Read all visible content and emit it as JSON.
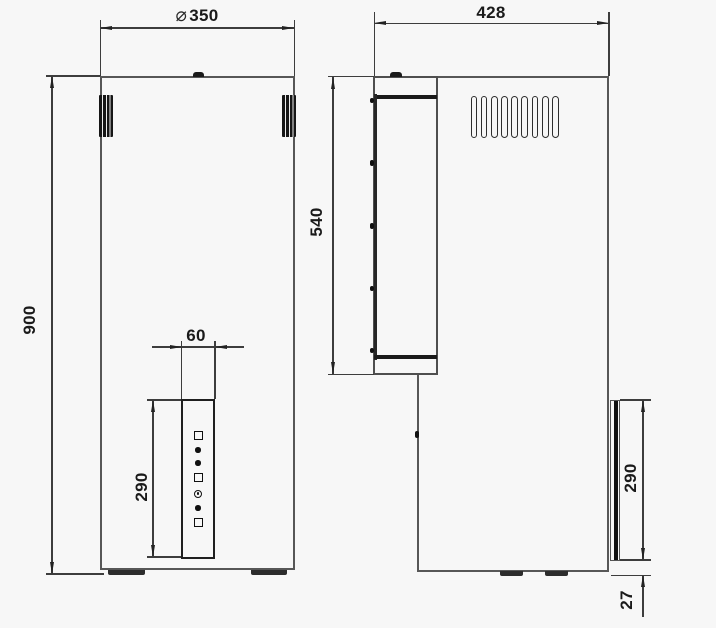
{
  "title": "appliance-dimension-drawing-two-views",
  "colors": {
    "background": "#f7f7f7",
    "outline": "#575757",
    "dimension_line": "#3d3d3d",
    "detail_dark": "#1a1a1a",
    "text": "#1a1a1a"
  },
  "dims": {
    "front_width": {
      "symbol": "⌀",
      "text": "350"
    },
    "front_height": {
      "text": "900"
    },
    "panel_width": {
      "text": "60"
    },
    "panel_height_front": {
      "text": "290"
    },
    "side_depth": {
      "text": "428"
    },
    "side_front_panel_height": {
      "text": "540"
    },
    "side_panel_height": {
      "text": "290"
    },
    "side_bottom_offset": {
      "text": "27"
    }
  },
  "front_view": {
    "control_panel_symbols": [
      "square",
      "dot",
      "dot",
      "square",
      "indicator",
      "dot",
      "square"
    ],
    "icons": [
      "top-cap-icon",
      "left-vent-grille-icon",
      "right-vent-grille-icon",
      "foot-icon",
      "foot-icon"
    ]
  },
  "side_view": {
    "vent_slot_count": 9,
    "screw_count_front_edge": 5,
    "icons": [
      "top-cap-icon",
      "vent-grille-icon",
      "screw-icon",
      "foot-icon",
      "foot-icon",
      "side-control-panel-bar"
    ]
  }
}
